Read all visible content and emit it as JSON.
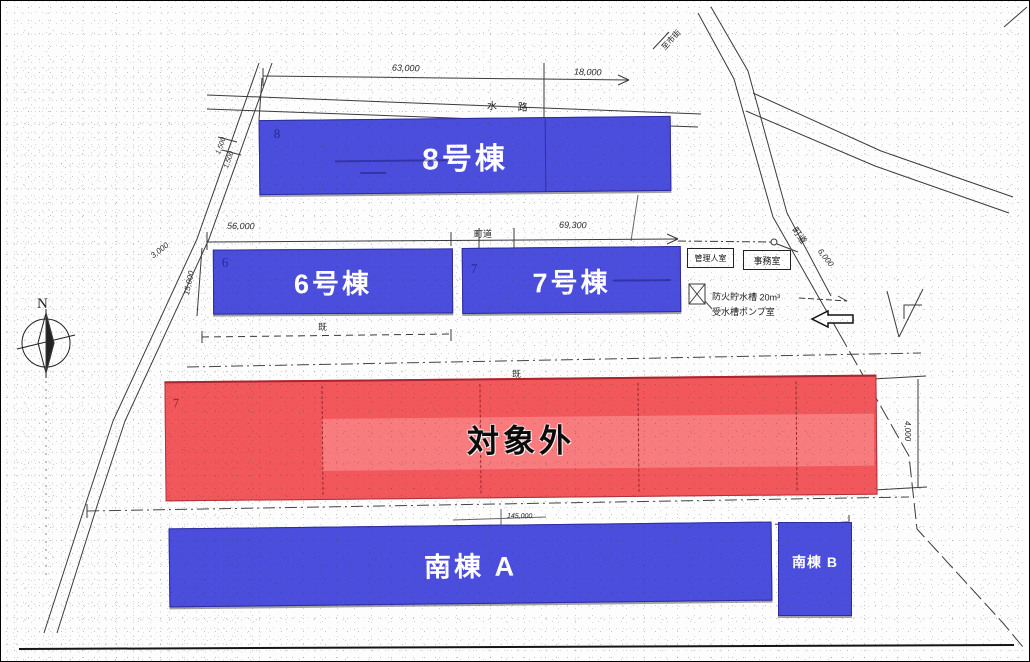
{
  "site_plan": {
    "title": "site layout plan (scanned)",
    "buildings": {
      "building8": "8号棟",
      "building6": "6号棟",
      "building7": "7号棟",
      "excluded": "対象外",
      "south_a": "南棟 A",
      "south_b": "南棟 B"
    },
    "block_numbers": {
      "n8": "8",
      "n6": "6",
      "n7": "7",
      "n7_red": "7"
    },
    "rooms": {
      "manager_room": "管理人室",
      "office": "事務室"
    },
    "roads": {
      "waterway": "水 路",
      "town_road": "町道",
      "town_road_diag": "町道",
      "destination": "至市街"
    },
    "notes": {
      "tank": "防火貯水槽 20m³",
      "pump": "受水槽ポンプ室",
      "existing_a": "既",
      "existing_b": "既"
    },
    "compass": {
      "north": "N"
    },
    "dimensions": {
      "d63000": "63,000",
      "d18000": "18,000",
      "d56000": "56,000",
      "d69300": "69,300",
      "d3000": "3,000",
      "d15000": "15,000",
      "d1500_a": "1,500",
      "d1500_b": "1,500",
      "d6000": "6,000",
      "d4000": "4,000",
      "d145000": "145,000"
    },
    "colors": {
      "building_blue": "#4b4edc",
      "excluded_red": "#f2575c",
      "excluded_band": "#f87e81",
      "linework": "#3b3b3b"
    }
  }
}
